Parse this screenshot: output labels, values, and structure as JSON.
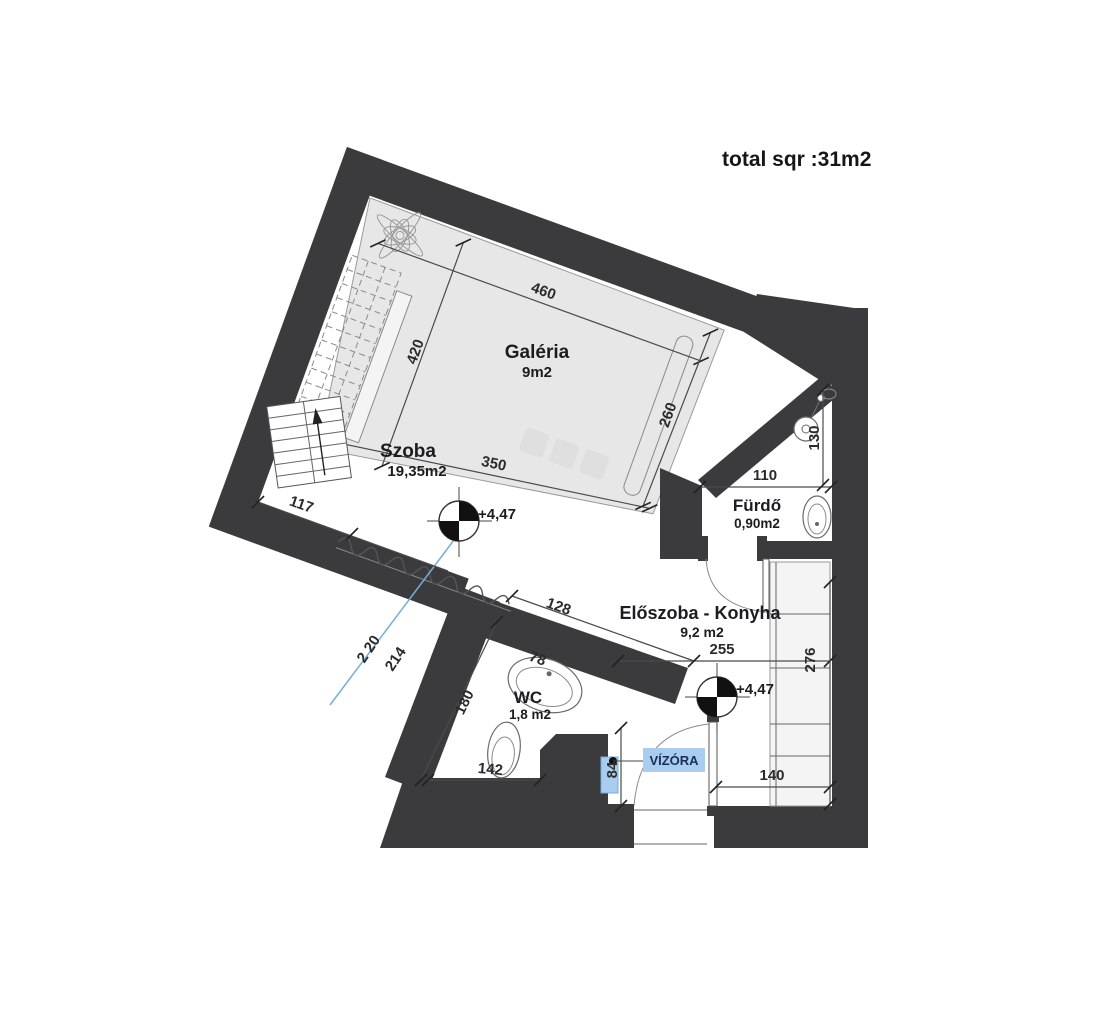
{
  "title": "total sqr :31m2",
  "rooms": {
    "galeria": {
      "name": "Galéria",
      "area": "9m2"
    },
    "szoba": {
      "name": "Szoba",
      "area": "19,35m2"
    },
    "furdo": {
      "name": "Fürdő",
      "area": "0,90m2"
    },
    "eloszoba_konyha": {
      "name": "Előszoba - Konyha",
      "area": "9,2 m2"
    },
    "wc": {
      "name": "WC",
      "area": "1,8 m2"
    }
  },
  "dimensions_cm": {
    "galeria_top": "460",
    "galeria_left": "420",
    "galeria_bottom": "350",
    "galeria_right": "260",
    "furdo_width": "110",
    "furdo_height": "130",
    "szoba_bottom": "117",
    "opening_width": "128",
    "wc_sink": "78",
    "wc_depth": "180",
    "wc_width": "142",
    "section_a": "2 20",
    "section_b": "214",
    "hall_width": "255",
    "hall_depth": "276",
    "hall_door": "140",
    "meter_offset": "84"
  },
  "elevation_markers": {
    "szoba": "+4,47",
    "eloszoba": "+4,47"
  },
  "labels": {
    "water_meter": "VÍZÓRA"
  },
  "colors": {
    "wall": "#3b3b3d",
    "gallery_fill": "#e7e7e7",
    "highlight_blue": "#a9cdf0",
    "section_line_blue": "#74aed8",
    "text": "#1d1d1f"
  }
}
